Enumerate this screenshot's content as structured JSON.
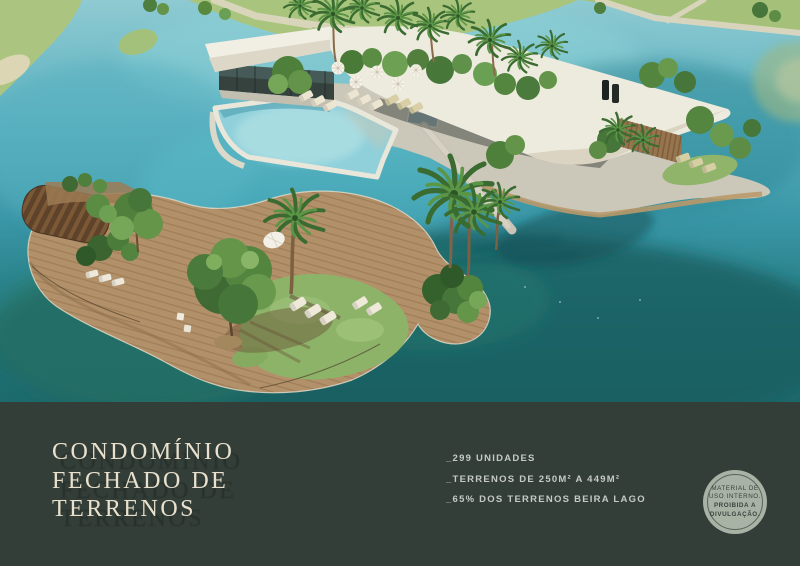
{
  "slide": {
    "title_lines": [
      "CONDOMÍNIO",
      "FECHADO DE",
      "TERRENOS"
    ],
    "bullets": [
      "_299 UNIDADES",
      "_TERRENOS DE 250M² A 449M²",
      "_65% DOS TERRENOS BEIRA LAGO"
    ],
    "badge_lines": [
      "MATERIAL DE",
      "USO INTERNO.",
      "PROIBIDA A",
      "DIVULGAÇÃO."
    ]
  },
  "colors": {
    "footer_bg": "#343E38",
    "title_text": "#E9E1CD",
    "bullet_text": "#C5CBC4",
    "badge_bg": "#A8B2A5",
    "badge_ring": "#56655A",
    "badge_text": "#39443C",
    "water_light": "#8FCAD2",
    "water_mid": "#3996A6",
    "water_dark": "#1D6A6C",
    "grass_green": "#ABC581",
    "roof_white": "#EEEADF",
    "pool_turquoise": "#8FD0DA",
    "deck_wood": "#B2916A"
  }
}
